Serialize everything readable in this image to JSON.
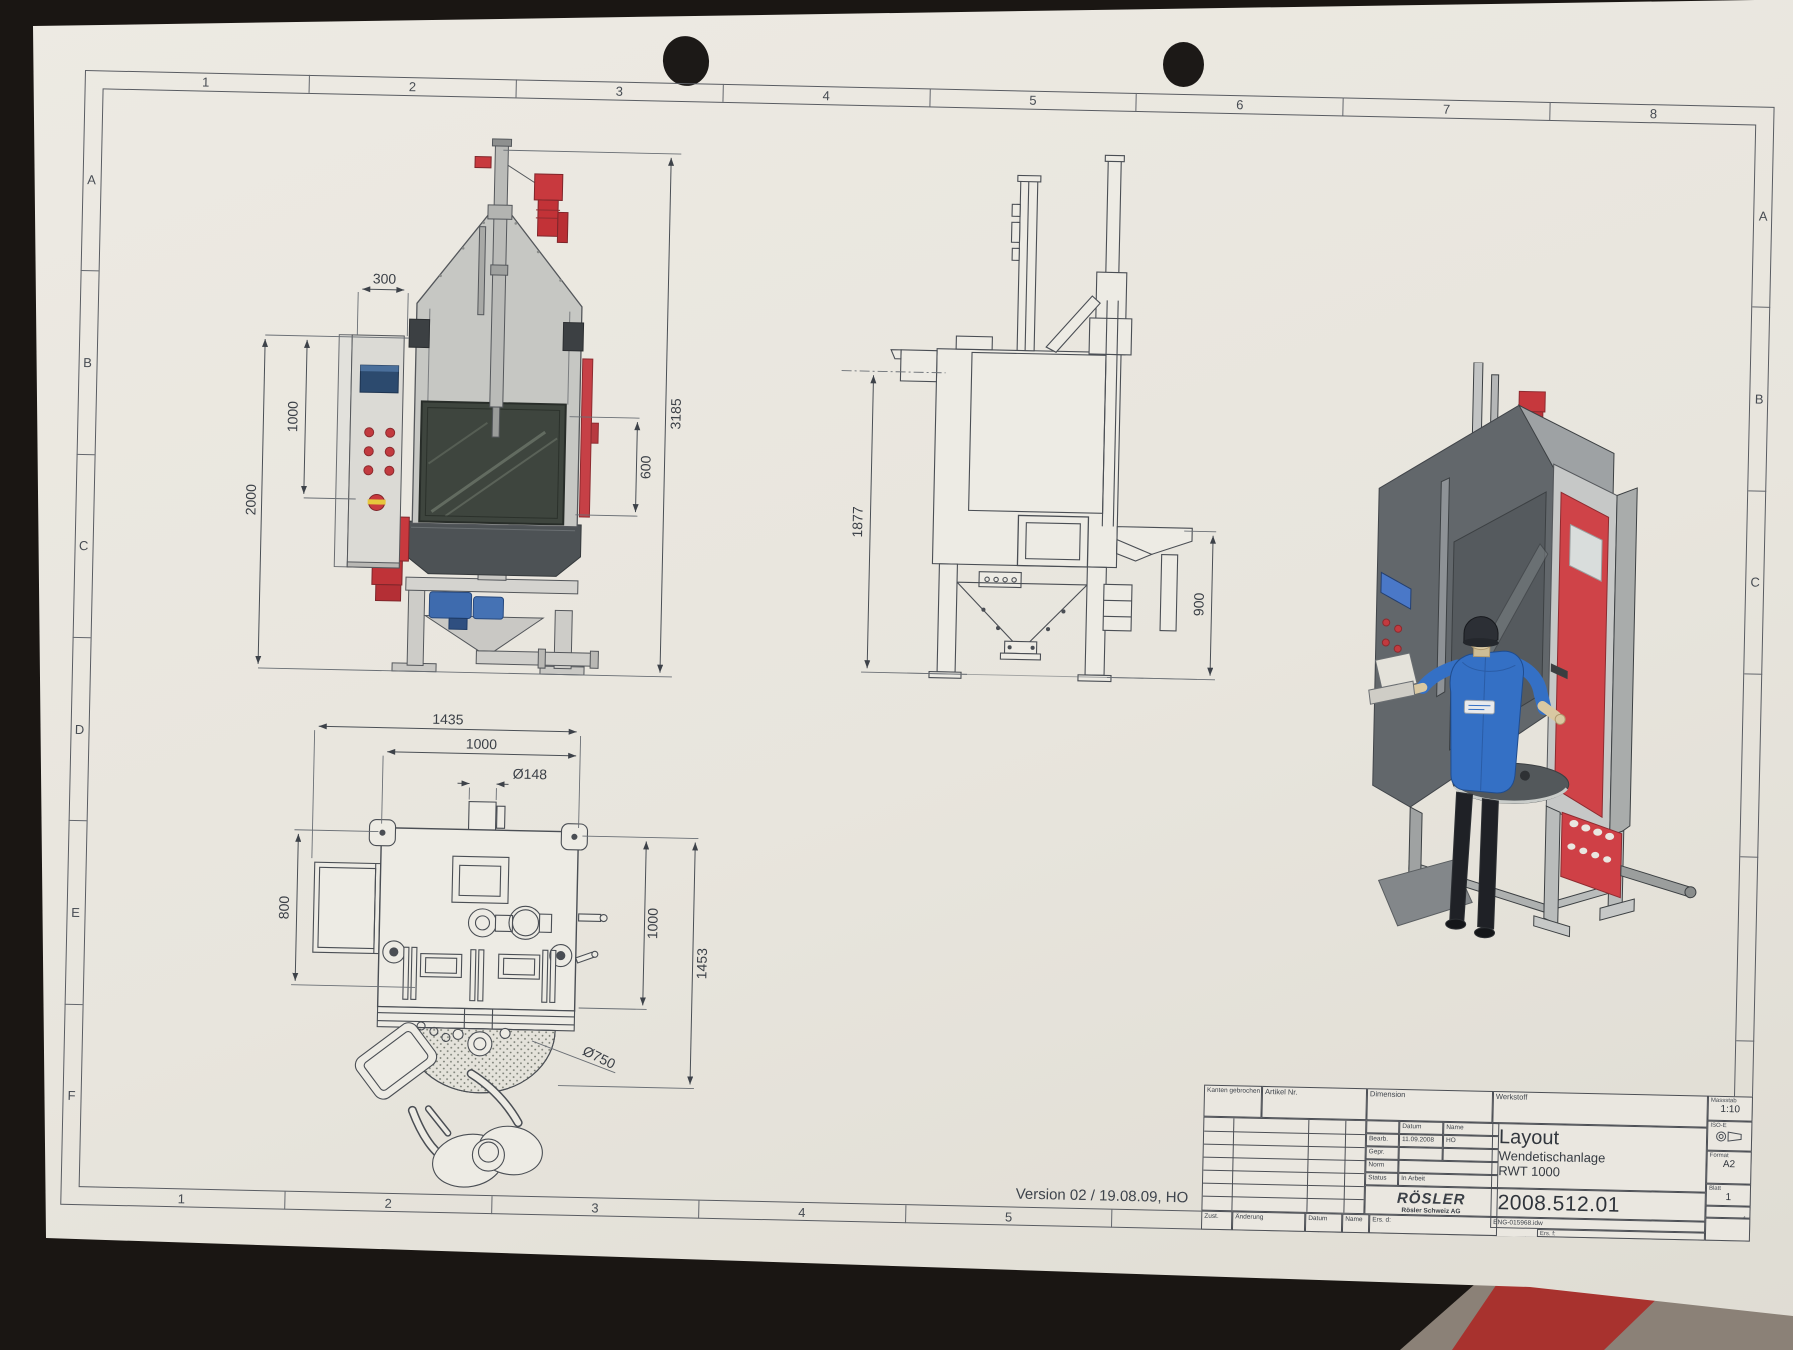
{
  "border": {
    "top_numbers": [
      "1",
      "2",
      "3",
      "4",
      "5",
      "6",
      "7",
      "8"
    ],
    "bottom_numbers": [
      "1",
      "2",
      "3",
      "4",
      "5"
    ],
    "left_letters": [
      "A",
      "B",
      "C",
      "D",
      "E",
      "F"
    ],
    "right_letters": [
      "A",
      "B",
      "C"
    ]
  },
  "note": {
    "version": "Version 02 / 19.08.09, HO"
  },
  "views": {
    "front": {
      "dim_300": "300",
      "dim_1000": "1000",
      "dim_2000": "2000",
      "dim_3185": "3185",
      "dim_600": "600"
    },
    "side": {
      "dim_1877": "1877",
      "dim_900": "900"
    },
    "top": {
      "dim_1435": "1435",
      "dim_1000_top": "1000",
      "dim_d148": "Ø148",
      "dim_800": "800",
      "dim_1000_right": "1000",
      "dim_1453": "1453",
      "dim_d750": "Ø750"
    }
  },
  "title_block": {
    "kanten": "Kanten gebrochen",
    "artikel": "Artikel Nr.",
    "dimension": "Dimension",
    "werkstoff": "Werkstoff",
    "datum_header": "Datum",
    "name_header": "Name",
    "bearb_label": "Bearb.",
    "bearb_datum": "11.09.2008",
    "bearb_name": "HO",
    "gepr_label": "Gepr.",
    "norm_label": "Norm",
    "status_label": "Status",
    "status_value": "In Arbeit",
    "logo": "RÖSLER",
    "logo_sub": "Rösler Schweiz AG",
    "title_line1": "Layout",
    "title_line2": "Wendetischanlage",
    "title_line3": "RWT 1000",
    "drawing_number": "2008.512.01",
    "file_name": "ENG-015968.idw",
    "ers_f": "Ers. f:",
    "ers_d": "Ers. d:",
    "zust": "Zust.",
    "aenderung": "Änderung",
    "datum_col": "Datum",
    "name_col": "Name",
    "massstab_label": "Massstab",
    "massstab_value": "1:10",
    "iso_label": "ISO-E",
    "format_label": "Format",
    "format_value": "A2",
    "blatt_label": "Blatt",
    "blatt_value": "1",
    "blatt_total": "1"
  }
}
